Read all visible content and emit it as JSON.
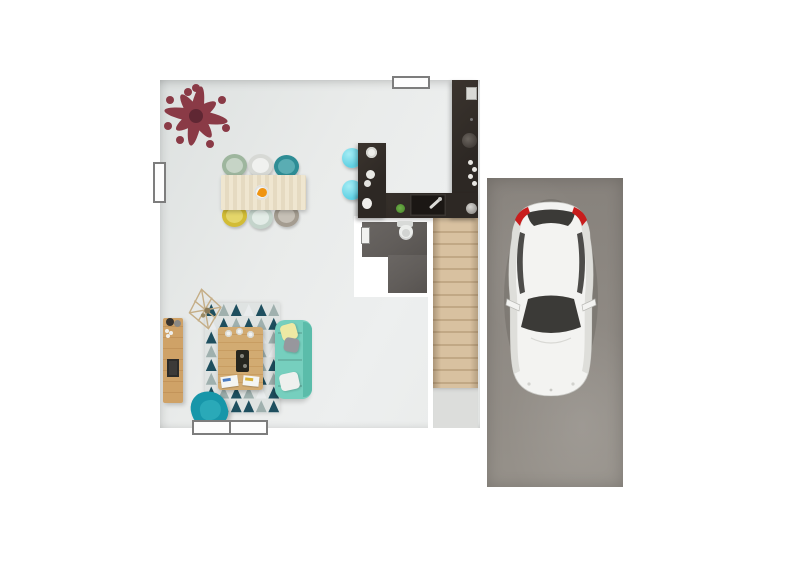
{
  "colors": {
    "page_bg": "#ffffff",
    "floor": "#e9ebea",
    "floor_dark": "#dde1e0",
    "wall": "#ffffff",
    "window_frame": "#7d7d7d",
    "kitchen_counter": "#2d2824",
    "kitchen_counter_light": "#3b342e",
    "sink": "#1b1714",
    "stool": "#62d2e4",
    "herb_plant": "#4f8f2f",
    "coral_plant": "#8a3a46",
    "coral_plant_dark": "#5f2733",
    "dining_table": "#e9dfc8",
    "centerpiece": "#ef9412",
    "bathroom_floor": "#615d5a",
    "toilet": "#eceeec",
    "stair_wood": "#d8c1a0",
    "stair_line": "#b99f7c",
    "stair_landing": "#dcdddb",
    "tv_stand": "#c99c60",
    "tv": "#3c3a38",
    "rug_teal": "#1e4f5f",
    "rug_gray": "#9fb0ae",
    "rug_white": "#e9eced",
    "rug_base": "#dfe3e2",
    "coffee_table": "#cfa76c",
    "tray": "#26261f",
    "sofa": "#76cfbe",
    "sofa_back": "#5bbcaa",
    "pillow_yellow": "#eee9a4",
    "pillow_gray": "#97979d",
    "pillow_white": "#eef0ee",
    "armchair": "#1796a9",
    "armchair_light": "#2aa9b8",
    "garage_floor": "#8e8983",
    "car_body": "#f3f3f1",
    "car_shade": "#dededa",
    "car_glass": "#3b3a37",
    "taillight": "#c81d1d"
  },
  "dining": {
    "chair_count": 6,
    "chairs": [
      {
        "name": "chair-sage",
        "rim": "#9eb69e",
        "seat": "#c6d4c6"
      },
      {
        "name": "chair-white",
        "rim": "#d7d9d5",
        "seat": "#f0f1ef"
      },
      {
        "name": "chair-teal",
        "rim": "#2e8d95",
        "seat": "#5aadb3"
      },
      {
        "name": "chair-yellow",
        "rim": "#d2bc35",
        "seat": "#e4d66a"
      },
      {
        "name": "chair-mint",
        "rim": "#c4d4cb",
        "seat": "#e3ece7"
      },
      {
        "name": "chair-gray",
        "rim": "#a49c90",
        "seat": "#c6c0b6"
      }
    ]
  },
  "kitchen": {
    "stool_count": 2,
    "shape": "u-shaped-counter"
  },
  "bathroom": {
    "fixtures": [
      "toilet",
      "radiator"
    ]
  },
  "stairs": {
    "tread_count": 13
  },
  "living_room": {
    "rug": {
      "cols": 6,
      "rows": 8,
      "pattern": [
        "tgtwtg",
        "wtgtgt",
        "tgwtwg",
        "gtttgw",
        "twgtgt",
        "gttwtg",
        "tgtgwt",
        "wgttgt"
      ]
    },
    "pillow_count": 3
  },
  "garage": {
    "vehicle": "white-hatchback-top-view"
  },
  "coral": {
    "branch_count": 4,
    "tip_count": 8
  }
}
